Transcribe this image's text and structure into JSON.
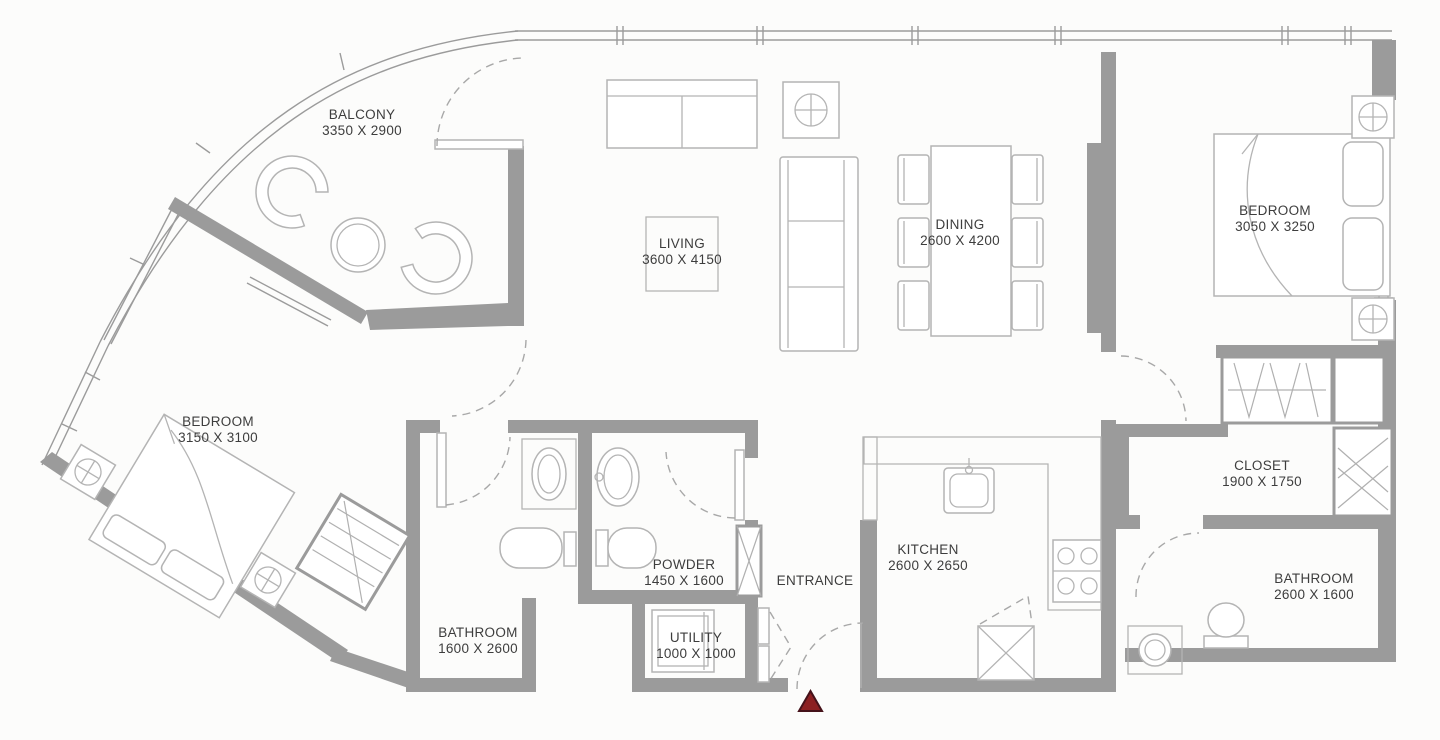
{
  "plan": {
    "title": "2 Bedroom Apartment Floor Plan",
    "entrance_marker": "entrance-direction-triangle"
  },
  "rooms": {
    "balcony": {
      "name": "BALCONY",
      "dims": "3350 X 2900"
    },
    "living": {
      "name": "LIVING",
      "dims": "3600 X 4150"
    },
    "dining": {
      "name": "DINING",
      "dims": "2600 X 4200"
    },
    "bedroom_right": {
      "name": "BEDROOM",
      "dims": "3050 X 3250"
    },
    "bedroom_left": {
      "name": "BEDROOM",
      "dims": "3150 X 3100"
    },
    "closet": {
      "name": "CLOSET",
      "dims": "1900 X 1750"
    },
    "kitchen": {
      "name": "KITCHEN",
      "dims": "2600 X 2650"
    },
    "powder": {
      "name": "POWDER",
      "dims": "1450 X 1600"
    },
    "entrance": {
      "name": "ENTRANCE",
      "dims": ""
    },
    "bathroom_left": {
      "name": "BATHROOM",
      "dims": "1600 X 2600"
    },
    "utility": {
      "name": "UTILITY",
      "dims": "1000 X 1000"
    },
    "bathroom_right": {
      "name": "BATHROOM",
      "dims": "2600 X 1600"
    }
  },
  "colors": {
    "wall": "#9b9b9b",
    "furniture_line": "#b4b4b4",
    "label_text": "#3d3d3d",
    "entrance_marker": "#8c2022",
    "entrance_marker_border": "#45121a",
    "background": "#fcfcfb"
  }
}
